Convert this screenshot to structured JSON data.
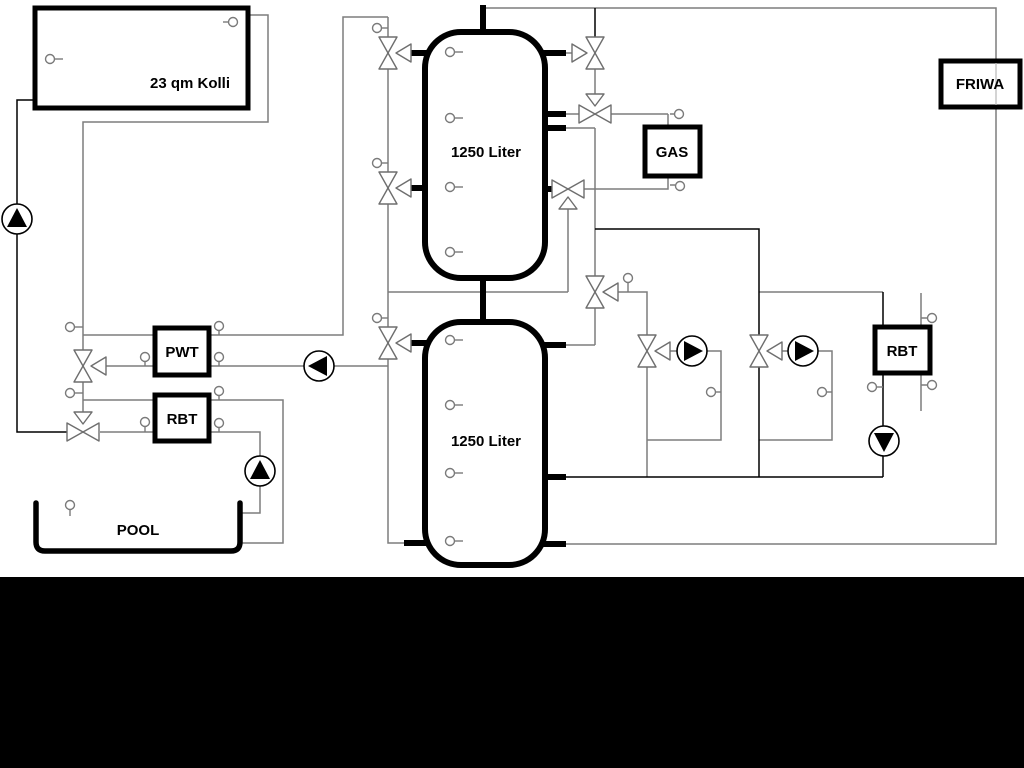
{
  "diagram": {
    "type": "hydraulic-schematic",
    "labels": {
      "collector": "23 qm Kolli",
      "tank_top": "1250 Liter",
      "tank_bottom": "1250 Liter",
      "pwt": "PWT",
      "rbt_left": "RBT",
      "rbt_right": "RBT",
      "gas": "GAS",
      "friwa": "FRIWA",
      "pool": "POOL"
    },
    "colors": {
      "pipe": "#7d7d7d",
      "pipe_dark": "#000000",
      "component_border": "#000000",
      "background": "#ffffff",
      "bottom_band": "#000000"
    }
  }
}
